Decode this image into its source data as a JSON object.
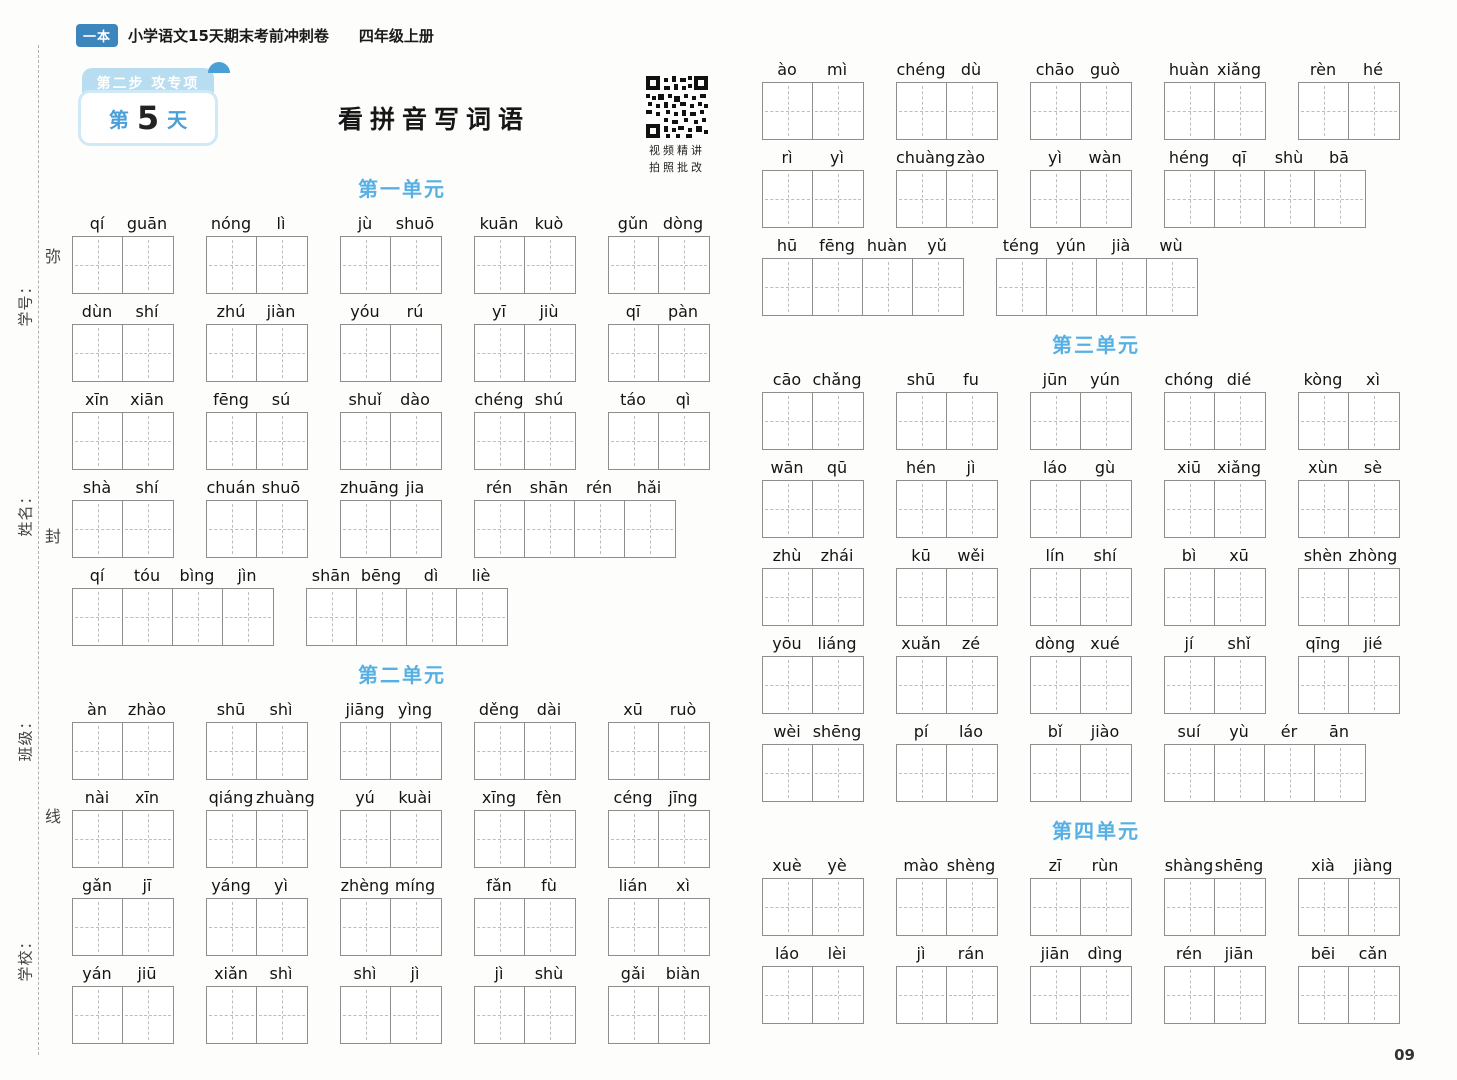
{
  "colors": {
    "brand": "#3c85bd",
    "accent": "#4a9fd6",
    "lightblue": "#b9ddf0",
    "unitblue": "#57b0e4"
  },
  "header": {
    "logo": "一本",
    "title": "小学语文15天期末考前冲刺卷",
    "subtitle": "四年级上册"
  },
  "badge": {
    "ribbon": "第二步 攻专项",
    "day_prefix": "第",
    "day_number": "5",
    "day_suffix": "天"
  },
  "page_title": "看拼音写词语",
  "qr": {
    "caption_line1": "视频精讲",
    "caption_line2": "拍照批改"
  },
  "sidebar": {
    "labels": [
      "学号：",
      "姓名：",
      "班级：",
      "学校："
    ],
    "seal_chars": [
      "弥",
      "封",
      "线"
    ]
  },
  "page_number": "09",
  "columns": {
    "left": {
      "sections": [
        {
          "title": "第一单元",
          "rows": [
            [
              [
                "qí",
                "guān"
              ],
              [
                "nóng",
                "lì"
              ],
              [
                "jù",
                "shuō"
              ],
              [
                "kuān",
                "kuò"
              ],
              [
                "gǔn",
                "dòng"
              ]
            ],
            [
              [
                "dùn",
                "shí"
              ],
              [
                "zhú",
                "jiàn"
              ],
              [
                "yóu",
                "rú"
              ],
              [
                "yī",
                "jiù"
              ],
              [
                "qī",
                "pàn"
              ]
            ],
            [
              [
                "xīn",
                "xiān"
              ],
              [
                "fēng",
                "sú"
              ],
              [
                "shuǐ",
                "dào"
              ],
              [
                "chéng",
                "shú"
              ],
              [
                "táo",
                "qì"
              ]
            ],
            [
              [
                "shà",
                "shí"
              ],
              [
                "chuán",
                "shuō"
              ],
              [
                "zhuāng",
                "jia"
              ],
              [
                "rén",
                "shān",
                "rén",
                "hǎi"
              ]
            ],
            [
              [
                "qí",
                "tóu",
                "bìng",
                "jìn"
              ],
              [
                "shān",
                "bēng",
                "dì",
                "liè"
              ]
            ]
          ]
        },
        {
          "title": "第二单元",
          "rows": [
            [
              [
                "àn",
                "zhào"
              ],
              [
                "shū",
                "shì"
              ],
              [
                "jiāng",
                "yìng"
              ],
              [
                "děng",
                "dài"
              ],
              [
                "xū",
                "ruò"
              ]
            ],
            [
              [
                "nài",
                "xīn"
              ],
              [
                "qiáng",
                "zhuàng"
              ],
              [
                "yú",
                "kuài"
              ],
              [
                "xīng",
                "fèn"
              ],
              [
                "céng",
                "jīng"
              ]
            ],
            [
              [
                "gǎn",
                "jī"
              ],
              [
                "yáng",
                "yì"
              ],
              [
                "zhèng",
                "míng"
              ],
              [
                "fǎn",
                "fù"
              ],
              [
                "lián",
                "xì"
              ]
            ],
            [
              [
                "yán",
                "jiū"
              ],
              [
                "xiǎn",
                "shì"
              ],
              [
                "shì",
                "jì"
              ],
              [
                "jì",
                "shù"
              ],
              [
                "gǎi",
                "biàn"
              ]
            ]
          ]
        }
      ]
    },
    "right": {
      "sections": [
        {
          "title": "",
          "rows": [
            [
              [
                "ào",
                "mì"
              ],
              [
                "chéng",
                "dù"
              ],
              [
                "chāo",
                "guò"
              ],
              [
                "huàn",
                "xiǎng"
              ],
              [
                "rèn",
                "hé"
              ]
            ],
            [
              [
                "rì",
                "yì"
              ],
              [
                "chuàng",
                "zào"
              ],
              [
                "yì",
                "wàn"
              ],
              [
                "héng",
                "qī",
                "shù",
                "bā"
              ]
            ],
            [
              [
                "hū",
                "fēng",
                "huàn",
                "yǔ"
              ],
              [
                "téng",
                "yún",
                "jià",
                "wù"
              ]
            ]
          ]
        },
        {
          "title": "第三单元",
          "rows": [
            [
              [
                "cāo",
                "chǎng"
              ],
              [
                "shū",
                "fu"
              ],
              [
                "jūn",
                "yún"
              ],
              [
                "chóng",
                "dié"
              ],
              [
                "kòng",
                "xì"
              ]
            ],
            [
              [
                "wān",
                "qū"
              ],
              [
                "hén",
                "jì"
              ],
              [
                "láo",
                "gù"
              ],
              [
                "xiū",
                "xiǎng"
              ],
              [
                "xùn",
                "sè"
              ]
            ],
            [
              [
                "zhù",
                "zhái"
              ],
              [
                "kū",
                "wěi"
              ],
              [
                "lín",
                "shí"
              ],
              [
                "bì",
                "xū"
              ],
              [
                "shèn",
                "zhòng"
              ]
            ],
            [
              [
                "yōu",
                "liáng"
              ],
              [
                "xuǎn",
                "zé"
              ],
              [
                "dòng",
                "xué"
              ],
              [
                "jí",
                "shǐ"
              ],
              [
                "qīng",
                "jié"
              ]
            ],
            [
              [
                "wèi",
                "shēng"
              ],
              [
                "pí",
                "láo"
              ],
              [
                "bǐ",
                "jiào"
              ],
              [
                "suí",
                "yù",
                "ér",
                "ān"
              ]
            ]
          ]
        },
        {
          "title": "第四单元",
          "rows": [
            [
              [
                "xuè",
                "yè"
              ],
              [
                "mào",
                "shèng"
              ],
              [
                "zī",
                "rùn"
              ],
              [
                "shàng",
                "shēng"
              ],
              [
                "xià",
                "jiàng"
              ]
            ],
            [
              [
                "láo",
                "lèi"
              ],
              [
                "jì",
                "rán"
              ],
              [
                "jiān",
                "dìng"
              ],
              [
                "rén",
                "jiān"
              ],
              [
                "bēi",
                "cǎn"
              ]
            ]
          ]
        }
      ]
    }
  }
}
